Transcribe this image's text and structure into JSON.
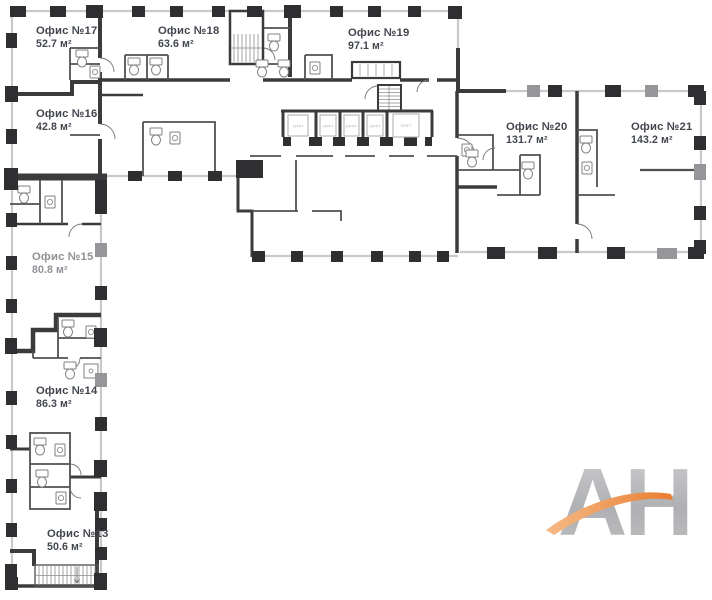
{
  "plan": {
    "offices": [
      {
        "id": "office-17",
        "name": "Офис №17",
        "area": "52.7 м²",
        "label_color": "#42464e"
      },
      {
        "id": "office-18",
        "name": "Офис №18",
        "area": "63.6 м²",
        "label_color": "#42464e"
      },
      {
        "id": "office-19",
        "name": "Офис №19",
        "area": "97.1 м²",
        "label_color": "#42464e"
      },
      {
        "id": "office-16",
        "name": "Офис №16",
        "area": "42.8 м²",
        "label_color": "#42464e"
      },
      {
        "id": "office-20",
        "name": "Офис №20",
        "area": "131.7 м²",
        "label_color": "#42464e"
      },
      {
        "id": "office-21",
        "name": "Офис №21",
        "area": "143.2 м²",
        "label_color": "#42464e"
      },
      {
        "id": "office-15",
        "name": "Офис №15",
        "area": "80.8 м²",
        "label_color": "#8f9196"
      },
      {
        "id": "office-14",
        "name": "Офис №14",
        "area": "86.3 м²",
        "label_color": "#42464e"
      },
      {
        "id": "office-13",
        "name": "Офис №13",
        "area": "50.6 м²",
        "label_color": "#42464e"
      }
    ],
    "lift_label": "ЛИФТ"
  },
  "watermark": {
    "text": "АН"
  },
  "colors": {
    "wall_dark": "#3b3b3d",
    "wall_light": "#c9c9ca",
    "pillar_dark": "#2f2f31",
    "pillar_gray": "#96969a",
    "background": "#ffffff",
    "swoosh_orange": "#ea7c28",
    "letters_gray": "#b0b1b4"
  }
}
